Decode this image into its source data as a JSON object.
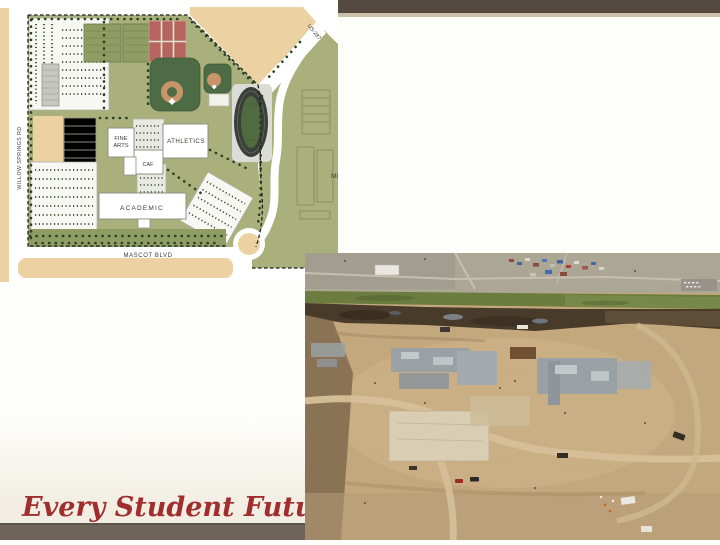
{
  "slide": {
    "tagline": "Every Student Future Ready",
    "colors": {
      "background": "#fdfdfa",
      "top_bar": "#544a42",
      "top_bar_underline": "#cbc1a9",
      "footer_bar": "#6f6459",
      "tagline_text": "#a02e2e"
    }
  },
  "site_plan": {
    "labels": {
      "fine_arts_line1": "FINE",
      "fine_arts_line2": "ARTS",
      "athletics": "ATHLETICS",
      "cafeteria": "CAF",
      "academic": "ACADEMIC",
      "mascot_blvd": "MASCOT BLVD",
      "willow_springs_rd": "WILLOW SPRINGS RD",
      "us_287": "US-287",
      "middle_school_partial": "MI"
    },
    "colors": {
      "landscape_green": "#a9b07c",
      "practice_field_green": "#8f9c63",
      "undeveloped_tan": "#ecd2a2",
      "tennis_red": "#b6655f",
      "baseball_green": "#4d6b44",
      "infield_tan": "#c8946a",
      "track_dark": "#3b3f3a",
      "track_infield": "#4f6b3f",
      "building_white": "#ffffff",
      "parking_light": "#f7f7f3",
      "tree_dark_green": "#27421f"
    }
  },
  "aerial_photo": {
    "subject": "construction-site-aerial",
    "colors": {
      "dirt_tan": "#c3a77d",
      "distant_ground": "#aca694",
      "green_field": "#6c7b3e",
      "burnt_earth": "#493b2a",
      "concrete_slab": "#9aa1a5",
      "light_pad": "#d9cdb3"
    }
  }
}
